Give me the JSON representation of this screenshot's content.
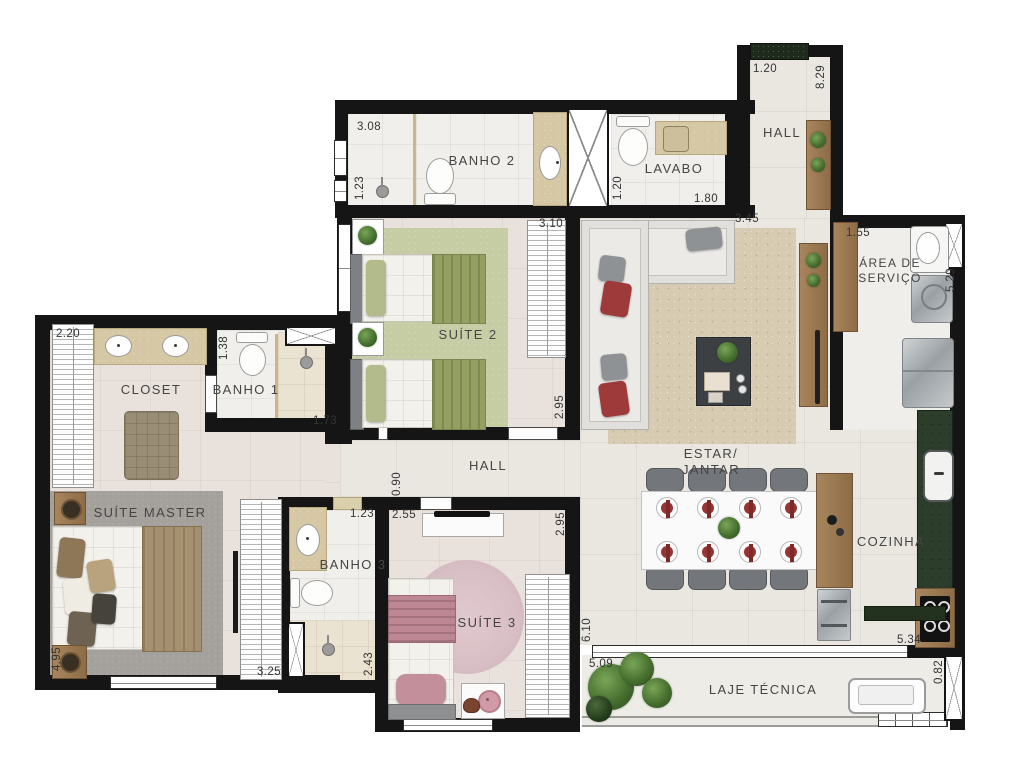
{
  "plan_title": "Apartment floor plan",
  "palette": {
    "wall": "#151515",
    "tile_floor": "#eae7e1",
    "bedroom_floor": "#e9e1db",
    "bath_floor": "#f1efeb",
    "shower_floor": "#ebe3d2",
    "counter_marble": "#d6c8a4",
    "wood": "#9c7a52",
    "granite_green": "#2c3d2c",
    "rug_living": "#d7ccb2",
    "rug_suite2": "#c6cda5",
    "rug_master": "#a4a19c",
    "rug_suite3": "#d8bfc5",
    "accent_red": "#983434",
    "plant_green": "#47702f",
    "appliance_gray": "#9aa0a4"
  },
  "icons": {
    "plant-icon": "green radial circle",
    "shower-head-icon": "gray circle with stem",
    "duct-icon": "white box with diagonal cross",
    "toilet-icon": "tank rectangle + oval bowl",
    "sink-icon": "white oval with faucet dot",
    "cooktop-icon": "black square with 4 burner rings",
    "doormat-icon": "dark green mat"
  },
  "rooms": [
    {
      "id": "banho-2",
      "label": "BANHO 2",
      "x": 482,
      "y": 161
    },
    {
      "id": "lavabo",
      "label": "LAVABO",
      "x": 674,
      "y": 169
    },
    {
      "id": "hall-entry",
      "label": "HALL",
      "x": 782,
      "y": 133
    },
    {
      "id": "area-servico",
      "label": "ÁREA DE\nSERVIÇO",
      "x": 890,
      "y": 271,
      "size": 12
    },
    {
      "id": "suite-2",
      "label": "SUÍTE 2",
      "x": 468,
      "y": 335
    },
    {
      "id": "closet",
      "label": "CLOSET",
      "x": 151,
      "y": 390
    },
    {
      "id": "banho-1",
      "label": "BANHO 1",
      "x": 246,
      "y": 390
    },
    {
      "id": "suite-master",
      "label": "SUÍTE MASTER",
      "x": 150,
      "y": 513
    },
    {
      "id": "hall",
      "label": "HALL",
      "x": 488,
      "y": 466
    },
    {
      "id": "banho-3",
      "label": "BANHO 3",
      "x": 353,
      "y": 565
    },
    {
      "id": "suite-3",
      "label": "SUÍTE 3",
      "x": 487,
      "y": 623
    },
    {
      "id": "estar-jantar",
      "label": "ESTAR/\nJANTAR",
      "x": 711,
      "y": 462
    },
    {
      "id": "cozinha",
      "label": "COZINHA",
      "x": 891,
      "y": 542
    },
    {
      "id": "laje-tecnica",
      "label": "LAJE TÉCNICA",
      "x": 763,
      "y": 690
    }
  ],
  "dimensions": [
    {
      "value": "3.08",
      "x": 369,
      "y": 127
    },
    {
      "value": "1.23",
      "x": 360,
      "y": 188,
      "rot": true
    },
    {
      "value": "1.20",
      "x": 618,
      "y": 188,
      "rot": true
    },
    {
      "value": "1.80",
      "x": 706,
      "y": 199
    },
    {
      "value": "1.20",
      "x": 765,
      "y": 69
    },
    {
      "value": "8.29",
      "x": 821,
      "y": 77,
      "rot": true
    },
    {
      "value": "1.55",
      "x": 858,
      "y": 233
    },
    {
      "value": "5.29",
      "x": 951,
      "y": 280,
      "rot": true
    },
    {
      "value": "3.45",
      "x": 747,
      "y": 219
    },
    {
      "value": "3.10",
      "x": 551,
      "y": 224
    },
    {
      "value": "2.95",
      "x": 560,
      "y": 407,
      "rot": true
    },
    {
      "value": "2.20",
      "x": 68,
      "y": 334
    },
    {
      "value": "1.38",
      "x": 224,
      "y": 348,
      "rot": true
    },
    {
      "value": "1.73",
      "x": 325,
      "y": 421
    },
    {
      "value": "0.90",
      "x": 397,
      "y": 484,
      "rot": true
    },
    {
      "value": "4.95",
      "x": 57,
      "y": 659,
      "rot": true
    },
    {
      "value": "3.25",
      "x": 269,
      "y": 672
    },
    {
      "value": "1.23",
      "x": 362,
      "y": 514
    },
    {
      "value": "2.43",
      "x": 369,
      "y": 664,
      "rot": true
    },
    {
      "value": "2.55",
      "x": 404,
      "y": 515
    },
    {
      "value": "2.95",
      "x": 561,
      "y": 524,
      "rot": true
    },
    {
      "value": "6.10",
      "x": 587,
      "y": 630,
      "rot": true
    },
    {
      "value": "5.09",
      "x": 601,
      "y": 664
    },
    {
      "value": "5.34",
      "x": 909,
      "y": 640
    },
    {
      "value": "0.82",
      "x": 939,
      "y": 672,
      "rot": true
    }
  ]
}
